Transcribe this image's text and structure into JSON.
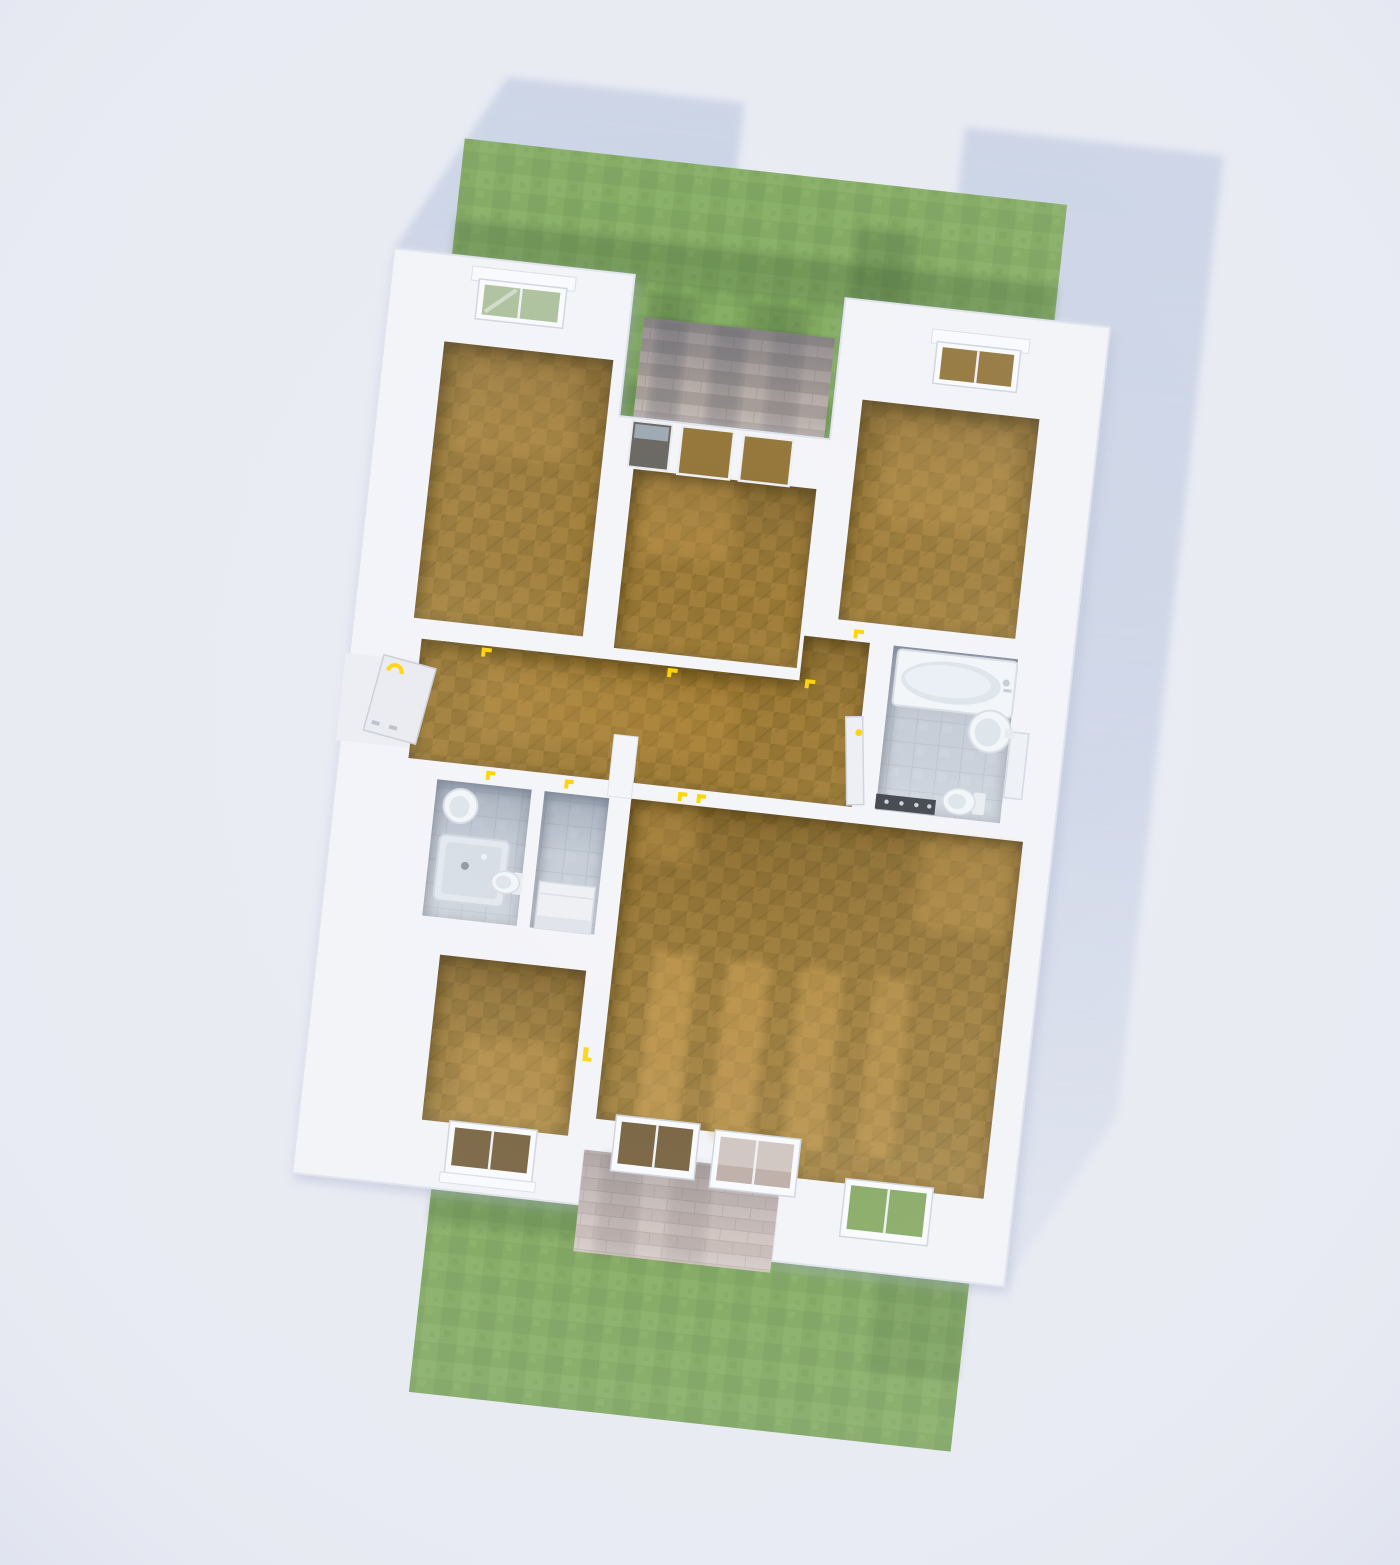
{
  "scene": {
    "title": "3D floor plan render, top-down view",
    "view": "bird's-eye orthographic, house rotated clockwise ~6 degrees",
    "house_rotation_deg": 6.3,
    "no_visible_text": true
  },
  "yard": {
    "front_lawn": "grass strip along top of house with shaded band near walls",
    "back_lawn": "large grass area below house",
    "porch_steps": "stone brick steps in recessed entry notch at top center",
    "patio": "stone paved terrace in notch at bottom center",
    "cast_shadow": "blue-grey building shadow offset up-right of house"
  },
  "rooms": [
    {
      "name": "bedroom-top-left",
      "floor": "wood",
      "features": [
        "window-north"
      ]
    },
    {
      "name": "bedroom-top-middle",
      "floor": "wood",
      "features": [
        "window-north",
        "two-wood-openings-to-porch"
      ]
    },
    {
      "name": "bedroom-top-right",
      "floor": "wood",
      "features": [
        "window-north"
      ]
    },
    {
      "name": "entry-hallway",
      "floor": "wood",
      "features": [
        "front-door-west-open",
        "doors-to-all-rooms"
      ]
    },
    {
      "name": "bathroom-main",
      "floor": "tile",
      "fixtures": [
        "bathtub",
        "wall-sink",
        "toilet",
        "radiator"
      ],
      "features": [
        "open-door-west",
        "window-east"
      ]
    },
    {
      "name": "bathroom-small",
      "floor": "tile",
      "fixtures": [
        "wall-sink",
        "shower-tray",
        "toilet"
      ]
    },
    {
      "name": "storage-room",
      "floor": "tile",
      "fixtures": [
        "white-cabinet"
      ]
    },
    {
      "name": "bedroom-bottom-left",
      "floor": "wood",
      "features": [
        "window-south"
      ]
    },
    {
      "name": "living-room",
      "floor": "wood",
      "features": [
        "two-windows-south",
        "window-south-east-wing",
        "light-stripes-on-floor"
      ]
    }
  ],
  "door_handle_color_note": "all interior door handles are small yellow marks",
  "palette": {
    "bg": "#e9ebf3",
    "bgCorner": "#dde1ee",
    "shadow": "#c5cfe3",
    "grass": "#74a04d",
    "grassDark": "#689247",
    "grassLight": "#80ab58",
    "stone": "#b0a49d",
    "stoneLight": "#bcafa8",
    "stoneDark": "#9c918b",
    "patio": "#c8b9b3",
    "wall": "#f4f5f9",
    "wallLine": "#dfe3ec",
    "wood": "#a07c35",
    "woodDark": "#8b6a2b",
    "woodLight": "#e0ad55",
    "tile": "#ccd3dc",
    "tileLine": "#b6bfcb",
    "porcelain": "#f3f6f9",
    "fixtureShade": "#dde4ea",
    "handle": "#ffd400",
    "glass": "#a8bd95",
    "darkGlass": "#63605a",
    "sillWood": "#6e5730"
  }
}
